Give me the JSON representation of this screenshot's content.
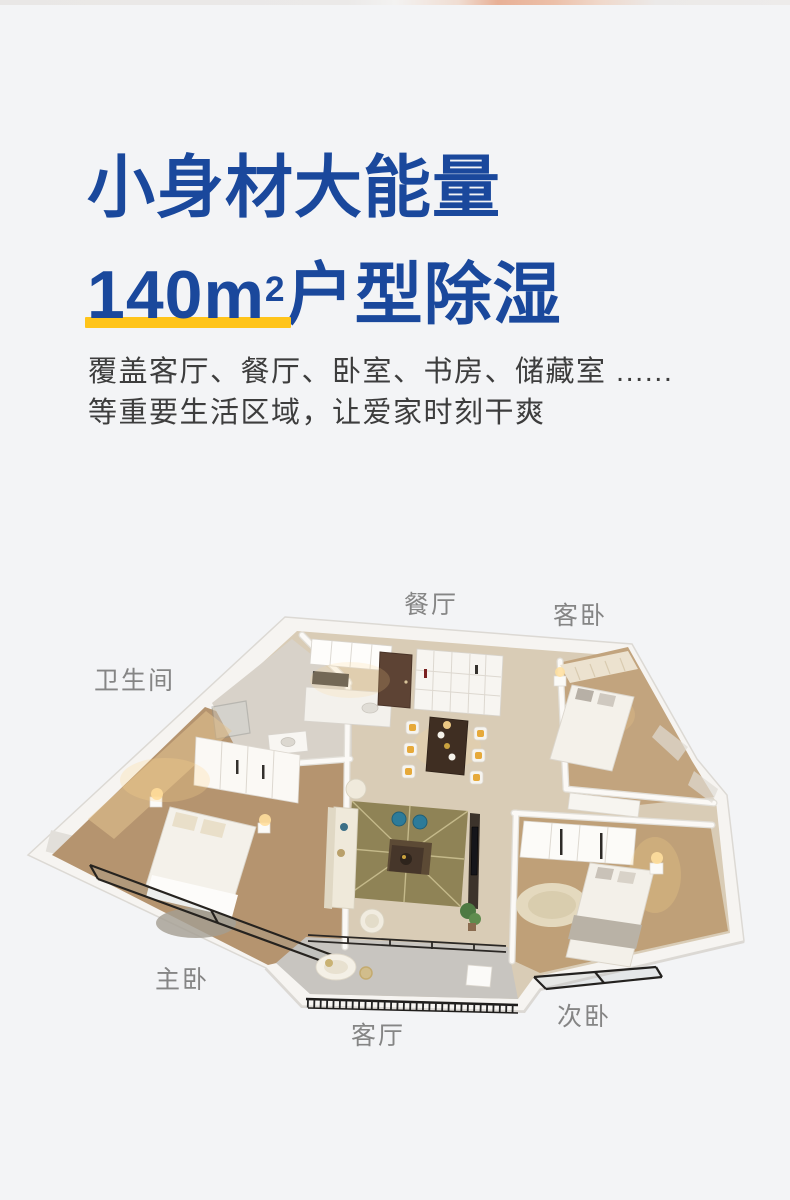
{
  "hero": {
    "title_line1": "小身材大能量",
    "title_line2_highlight": "140m",
    "title_line2_superscript": "2",
    "title_line2_rest": "户型除湿",
    "subtitle_line1": "覆盖客厅、餐厅、卧室、书房、储藏室 ......",
    "subtitle_line2": "等重要生活区域，让爱家时刻干爽",
    "colors": {
      "title": "#1a489c",
      "underline": "#ffc41a",
      "subtitle": "#3d3d3d"
    }
  },
  "floor_plan": {
    "kind": "3d-isometric-apartment-render",
    "label_color": "#858585",
    "room_labels": [
      {
        "id": "dining",
        "text": "餐厅"
      },
      {
        "id": "guest-bedroom",
        "text": "客卧"
      },
      {
        "id": "bathroom",
        "text": "卫生间"
      },
      {
        "id": "master-bedroom",
        "text": "主卧"
      },
      {
        "id": "living-room",
        "text": "客厅"
      },
      {
        "id": "second-bedroom",
        "text": "次卧"
      }
    ]
  }
}
